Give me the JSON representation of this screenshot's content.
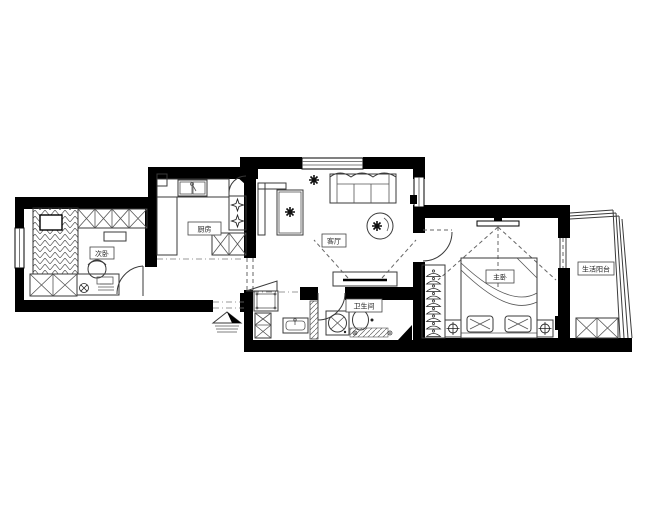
{
  "plan": {
    "title": "apartment-floor-plan",
    "rooms": {
      "secondary_bedroom": {
        "label": "次卧"
      },
      "kitchen": {
        "label": "厨房"
      },
      "living_room": {
        "label": "客厅"
      },
      "master_bedroom": {
        "label": "主卧"
      },
      "bathroom": {
        "label": "卫生间"
      },
      "balcony": {
        "label": "生活阳台"
      }
    },
    "colors": {
      "wall": "#000000",
      "furniture_line": "#3a3a3a",
      "background": "#ffffff"
    }
  }
}
